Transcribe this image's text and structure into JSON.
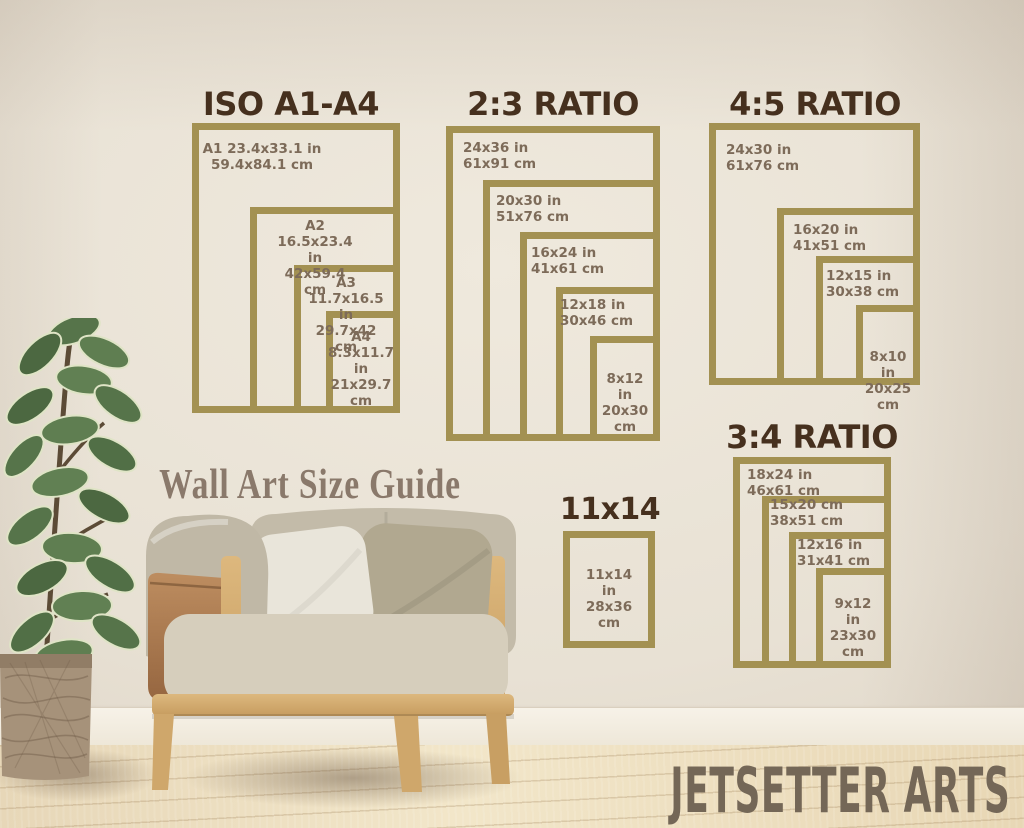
{
  "caption": "Wall Art Size Guide",
  "brand": "JETSETTER ARTS",
  "colors": {
    "frame": "#a39152",
    "title": "#46301e",
    "label": "#7d6b59",
    "caption": "#8a796b",
    "brand": "#746757"
  },
  "groups": {
    "iso": {
      "title": "ISO A1-A4",
      "frames": {
        "a1": "A1 23.4x33.1 in\n59.4x84.1 cm",
        "a2": "A2 16.5x23.4 in\n42x59.4 cm",
        "a3": "A3 11.7x16.5 in\n29.7x42 cm",
        "a4": "A4\n8.3x11.7 in\n21x29.7\ncm"
      }
    },
    "r23": {
      "title": "2:3 RATIO",
      "frames": {
        "s24x36": "24x36 in\n61x91 cm",
        "s20x30": "20x30 in\n51x76 cm",
        "s16x24": "16x24 in\n41x61 cm",
        "s12x18": "12x18 in\n30x46 cm",
        "s8x12": "8x12 in\n20x30\ncm"
      }
    },
    "r45": {
      "title": "4:5 RATIO",
      "frames": {
        "s24x30": "24x30 in\n61x76 cm",
        "s16x20": "16x20 in\n41x51 cm",
        "s12x15": "12x15 in\n30x38 cm",
        "s8x10": "8x10 in\n20x25\ncm"
      }
    },
    "r34": {
      "title": "3:4 RATIO",
      "frames": {
        "s18x24": "18x24 in\n46x61 cm",
        "s15x20": "15x20 cm\n38x51 cm",
        "s12x16": "12x16 in\n31x41 cm",
        "s9x12": "9x12 in\n23x30\ncm"
      }
    },
    "s1114": {
      "title": "11x14",
      "frames": {
        "s11x14": "11x14 in\n28x36\ncm"
      }
    }
  }
}
